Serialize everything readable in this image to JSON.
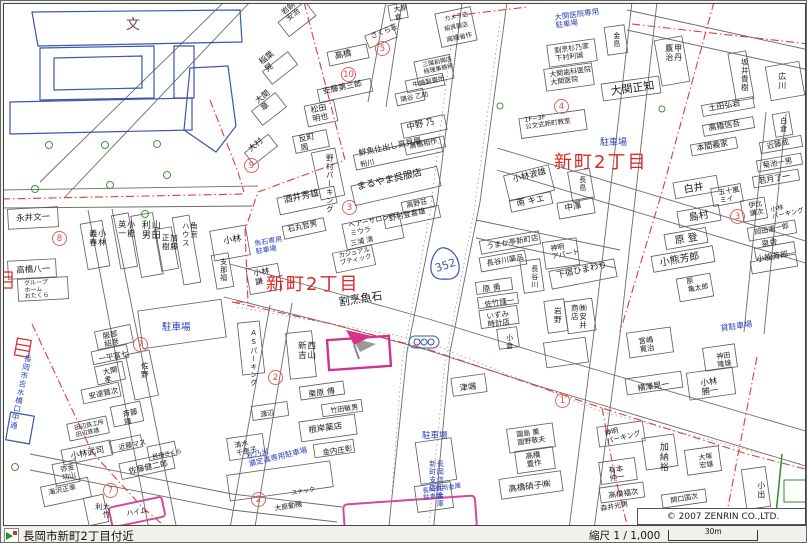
{
  "map": {
    "copyright": "© 2007 ZENRIN CO.,LTD.",
    "route_shield": {
      "number": "352"
    },
    "colors": {
      "boundary_red": "#e23b3b",
      "label_blue": "#2a3fb8",
      "district_red": "#e02525",
      "highlight_magenta": "#cf3390",
      "road_gray": "#666666",
      "school_blue": "#3a56b0",
      "tree_green": "#4a8f3f"
    },
    "district_labels": [
      {
        "t": "新町2丁目",
        "x": 262,
        "y": 271,
        "s": 18,
        "c": "r"
      },
      {
        "t": "新町2丁目",
        "x": 550,
        "y": 149,
        "s": 18,
        "c": "r"
      }
    ],
    "labels": [
      {
        "t": "文",
        "x": 122,
        "y": 14,
        "s": 14,
        "c": "p"
      },
      {
        "t": "稲葉\n晃",
        "x": 254,
        "y": 56,
        "s": 8,
        "r": -38
      },
      {
        "t": "大関\n章",
        "x": 250,
        "y": 95,
        "s": 8,
        "r": -38
      },
      {
        "t": "大村",
        "x": 243,
        "y": 143,
        "s": 8,
        "r": -38
      },
      {
        "t": "岩銅\n安治",
        "x": 276,
        "y": 6,
        "s": 7.5,
        "r": -38
      },
      {
        "t": "高橋",
        "x": 330,
        "y": 49,
        "s": 8.5,
        "r": -12
      },
      {
        "t": "安藤第三郎",
        "x": 318,
        "y": 84,
        "s": 8,
        "r": -12
      },
      {
        "t": "松田\n明也",
        "x": 306,
        "y": 103,
        "s": 8,
        "r": -12
      },
      {
        "t": "反町\n周",
        "x": 294,
        "y": 132,
        "s": 8,
        "r": -12
      },
      {
        "t": "さくら荘",
        "x": 366,
        "y": 30,
        "s": 7,
        "r": -22
      },
      {
        "t": "大原\n倉",
        "x": 389,
        "y": 3,
        "s": 7,
        "r": -10
      },
      {
        "t": "中野 乃",
        "x": 402,
        "y": 120,
        "s": 8.5,
        "r": -12
      },
      {
        "t": "高橋相作",
        "x": 405,
        "y": 140,
        "s": 7,
        "r": -12
      },
      {
        "t": "鮮魚仕出し高見屋",
        "x": 354,
        "y": 146,
        "s": 8,
        "r": -12
      },
      {
        "t": "粉川",
        "x": 356,
        "y": 158,
        "s": 7,
        "r": -12
      },
      {
        "t": "まるやま呉服店",
        "x": 352,
        "y": 179,
        "s": 9.5,
        "r": -13
      },
      {
        "t": "高野荘",
        "x": 402,
        "y": 199,
        "s": 7,
        "r": -12
      },
      {
        "t": "野村登喜雄",
        "x": 384,
        "y": 211,
        "s": 7.5,
        "r": -12
      },
      {
        "t": "ヘアーサロン\nミウラ",
        "x": 344,
        "y": 219,
        "s": 7,
        "r": -12
      },
      {
        "t": "三浦 清",
        "x": 346,
        "y": 237,
        "s": 7,
        "r": -12
      },
      {
        "t": "カジュアル\nブティック",
        "x": 334,
        "y": 249,
        "s": 6.5,
        "r": -12
      },
      {
        "t": "酒井秀雄",
        "x": 279,
        "y": 193,
        "s": 9,
        "r": -12
      },
      {
        "t": "石丸哲男",
        "x": 283,
        "y": 222,
        "s": 7.5,
        "r": -12
      },
      {
        "t": "小林\n謙",
        "x": 249,
        "y": 266,
        "s": 8,
        "r": -10
      },
      {
        "t": "割烹魚石",
        "x": 334,
        "y": 293,
        "s": 11,
        "r": -9
      },
      {
        "t": "野村パーキング",
        "x": 321,
        "y": 150,
        "s": 7.5,
        "v": true
      },
      {
        "t": "小林",
        "x": 219,
        "y": 234,
        "s": 9,
        "r": -10
      },
      {
        "t": "支那福",
        "x": 215,
        "y": 254,
        "s": 7,
        "v": true
      },
      {
        "t": "小林\n義春",
        "x": 84,
        "y": 225,
        "s": 8,
        "v": true
      },
      {
        "t": "小能\n英一",
        "x": 113,
        "y": 216,
        "s": 8,
        "v": true
      },
      {
        "t": "山田\n利男",
        "x": 135,
        "y": 216,
        "s": 9,
        "v": true
      },
      {
        "t": "加藤\n正樹",
        "x": 157,
        "y": 230,
        "s": 7.5,
        "v": true
      },
      {
        "t": "魚京\nハウス",
        "x": 177,
        "y": 218,
        "s": 7.5,
        "v": true
      },
      {
        "t": "永井文一",
        "x": 12,
        "y": 211,
        "s": 8.5,
        "r": -3
      },
      {
        "t": "高橋八一",
        "x": 12,
        "y": 263,
        "s": 8.5,
        "r": -3
      },
      {
        "t": "グループ\nホーム\nおたくら",
        "x": 20,
        "y": 277,
        "s": 6,
        "r": -3
      },
      {
        "t": "甲丹\n鷹治",
        "x": 660,
        "y": 40,
        "s": 8,
        "v": true
      },
      {
        "t": "坂井貴樹",
        "x": 736,
        "y": 54,
        "s": 7.5,
        "v": true
      },
      {
        "t": "広川",
        "x": 773,
        "y": 68,
        "s": 8,
        "v": true
      },
      {
        "t": "土田弘岩",
        "x": 704,
        "y": 101,
        "s": 8,
        "r": -10
      },
      {
        "t": "高橋信吾",
        "x": 704,
        "y": 121,
        "s": 8,
        "r": -10
      },
      {
        "t": "本間義家",
        "x": 692,
        "y": 141,
        "s": 8,
        "r": -10
      },
      {
        "t": "白倉",
        "x": 775,
        "y": 113,
        "s": 7,
        "v": true
      },
      {
        "t": "近藤成",
        "x": 762,
        "y": 139,
        "s": 7.5,
        "r": -12
      },
      {
        "t": "菊池一男",
        "x": 758,
        "y": 158,
        "s": 7.5,
        "r": -10
      },
      {
        "t": "若月了一",
        "x": 754,
        "y": 174,
        "s": 8,
        "r": -10
      },
      {
        "t": "五十嵐\nミイ",
        "x": 714,
        "y": 186,
        "s": 7,
        "r": -10
      },
      {
        "t": "白井",
        "x": 679,
        "y": 181,
        "s": 10,
        "r": -10
      },
      {
        "t": "島村",
        "x": 684,
        "y": 209,
        "s": 10,
        "r": -10
      },
      {
        "t": "原 登",
        "x": 670,
        "y": 232,
        "s": 10,
        "r": -10
      },
      {
        "t": "小熊芳郎",
        "x": 655,
        "y": 254,
        "s": 10,
        "r": -10
      },
      {
        "t": "原\n亀太郎",
        "x": 682,
        "y": 275,
        "s": 7,
        "r": -10
      },
      {
        "t": "伊比\n謙次",
        "x": 744,
        "y": 199,
        "s": 7,
        "r": -10
      },
      {
        "t": "小林\nパーキング",
        "x": 766,
        "y": 203,
        "s": 6.5,
        "r": -12
      },
      {
        "t": "岡田憲一郎",
        "x": 750,
        "y": 226,
        "s": 7,
        "r": -12
      },
      {
        "t": "泉舎",
        "x": 757,
        "y": 237,
        "s": 8,
        "r": -10
      },
      {
        "t": "小能芳郎",
        "x": 752,
        "y": 252,
        "s": 8,
        "r": -10
      },
      {
        "t": "大関正知",
        "x": 606,
        "y": 82,
        "s": 11,
        "r": -8
      },
      {
        "t": "割烹杉乃家\n下村利誠",
        "x": 550,
        "y": 44,
        "s": 7,
        "r": -8
      },
      {
        "t": "大関歯科医院\n大関医院",
        "x": 545,
        "y": 68,
        "s": 7,
        "r": -8
      },
      {
        "t": "金島",
        "x": 608,
        "y": 28,
        "s": 7,
        "v": true
      },
      {
        "t": "1F~3F\n公文式新町教室",
        "x": 520,
        "y": 113,
        "s": 6.5,
        "r": -8
      },
      {
        "t": "カメラ店",
        "x": 440,
        "y": 13,
        "s": 6,
        "r": -12
      },
      {
        "t": "紹呉服店",
        "x": 440,
        "y": 23,
        "s": 6,
        "r": -12
      },
      {
        "t": "高橋省作",
        "x": 442,
        "y": 33,
        "s": 6.5,
        "r": -12
      },
      {
        "t": "三陽創興店\n経理事務所",
        "x": 418,
        "y": 59,
        "s": 6,
        "r": -12
      },
      {
        "t": "中嶋製畳所",
        "x": 408,
        "y": 78,
        "s": 6.5,
        "r": -12
      },
      {
        "t": "隅谷 乙助",
        "x": 396,
        "y": 93,
        "s": 6.5,
        "r": -12
      },
      {
        "t": "小林波雄",
        "x": 508,
        "y": 172,
        "s": 8.5,
        "r": -14
      },
      {
        "t": "南 キエ",
        "x": 512,
        "y": 196,
        "s": 8.5,
        "r": -10
      },
      {
        "t": "中澤",
        "x": 560,
        "y": 201,
        "s": 8.5,
        "r": -10
      },
      {
        "t": "長島",
        "x": 574,
        "y": 172,
        "s": 7,
        "v": true
      },
      {
        "t": "うまか亭新町店",
        "x": 482,
        "y": 239,
        "s": 7.5,
        "r": -10
      },
      {
        "t": "長谷川薬品",
        "x": 482,
        "y": 256,
        "s": 7.5,
        "r": -10
      },
      {
        "t": "神明\nアパート",
        "x": 546,
        "y": 242,
        "s": 7,
        "r": -10
      },
      {
        "t": "下宿ひまわり",
        "x": 552,
        "y": 268,
        "s": 8.5,
        "r": -12
      },
      {
        "t": "長谷川",
        "x": 526,
        "y": 261,
        "s": 7,
        "v": true
      },
      {
        "t": "原 勇",
        "x": 478,
        "y": 282,
        "s": 8,
        "r": -8
      },
      {
        "t": "佐竹謹一",
        "x": 480,
        "y": 297,
        "s": 7.5,
        "r": -8
      },
      {
        "t": "いずみ\n時計店",
        "x": 482,
        "y": 309,
        "s": 7.5,
        "r": -8
      },
      {
        "t": "岩野",
        "x": 549,
        "y": 303,
        "s": 7.5,
        "v": true
      },
      {
        "t": "㈱安井\n商店",
        "x": 566,
        "y": 300,
        "s": 7.5,
        "v": true
      },
      {
        "t": "津端",
        "x": 455,
        "y": 381,
        "s": 8.5,
        "r": -8
      },
      {
        "t": "小倉",
        "x": 501,
        "y": 330,
        "s": 7,
        "v": true
      },
      {
        "t": "國島 薫\n國野敬夫",
        "x": 512,
        "y": 428,
        "s": 7,
        "r": -8
      },
      {
        "t": "高橋\n豊作",
        "x": 521,
        "y": 449,
        "s": 7.5,
        "r": -8
      },
      {
        "t": "高橋硝子㈱",
        "x": 504,
        "y": 482,
        "s": 8.5,
        "r": -8
      },
      {
        "t": "宮嶋\n寛治",
        "x": 634,
        "y": 334,
        "s": 7.5,
        "r": -8
      },
      {
        "t": "神田\n隆雄",
        "x": 712,
        "y": 350,
        "s": 7,
        "r": -8
      },
      {
        "t": "小林\n勝一",
        "x": 696,
        "y": 376,
        "s": 8.5,
        "r": -8
      },
      {
        "t": "横澤晃一",
        "x": 633,
        "y": 381,
        "s": 8,
        "r": -8
      },
      {
        "t": "神明\nパーキング",
        "x": 600,
        "y": 427,
        "s": 7,
        "r": -14
      },
      {
        "t": "加納裕",
        "x": 653,
        "y": 438,
        "s": 9,
        "v": true
      },
      {
        "t": "有本\n仲一",
        "x": 604,
        "y": 463,
        "s": 7.5,
        "r": -8
      },
      {
        "t": "大塚\n宏雄",
        "x": 694,
        "y": 451,
        "s": 7,
        "r": -8
      },
      {
        "t": "高橋福次",
        "x": 604,
        "y": 488,
        "s": 7.5,
        "r": -8
      },
      {
        "t": "関口国次",
        "x": 666,
        "y": 494,
        "s": 7,
        "r": -10
      },
      {
        "t": "小出",
        "x": 752,
        "y": 477,
        "s": 8,
        "v": true
      },
      {
        "t": "森井光男",
        "x": 596,
        "y": 502,
        "s": 7,
        "r": -10
      },
      {
        "t": "服部\n紹彦",
        "x": 98,
        "y": 329,
        "s": 7.5,
        "r": -12
      },
      {
        "t": "一平富七",
        "x": 94,
        "y": 352,
        "s": 7.5,
        "r": -12
      },
      {
        "t": "大関\n孝",
        "x": 98,
        "y": 365,
        "s": 7.5,
        "r": -12
      },
      {
        "t": "佐野",
        "x": 136,
        "y": 358,
        "s": 7.5,
        "v": true
      },
      {
        "t": "安達賢次",
        "x": 84,
        "y": 389,
        "s": 7.5,
        "r": -12
      },
      {
        "t": "斉藤\n隆",
        "x": 118,
        "y": 407,
        "s": 7.5,
        "r": -12
      },
      {
        "t": "田辺鉄工所\n田辺鉄雄",
        "x": 70,
        "y": 422,
        "s": 6,
        "r": -12
      },
      {
        "t": "近藤マス",
        "x": 114,
        "y": 441,
        "s": 7,
        "r": -12
      },
      {
        "t": "小林武司",
        "x": 66,
        "y": 449,
        "s": 8.5,
        "r": -12
      },
      {
        "t": "佐藤健二郎",
        "x": 124,
        "y": 464,
        "s": 8,
        "r": -12
      },
      {
        "t": "民宿さくら",
        "x": 148,
        "y": 451,
        "s": 6,
        "r": -12
      },
      {
        "t": "弥金\n功山",
        "x": 56,
        "y": 463,
        "s": 7,
        "r": -12
      },
      {
        "t": "滝沢正幸",
        "x": 44,
        "y": 486,
        "s": 7,
        "r": -12
      },
      {
        "t": "大竹利",
        "x": 90,
        "y": 499,
        "s": 7,
        "v": true
      },
      {
        "t": "ハイム",
        "x": 122,
        "y": 507,
        "s": 7,
        "r": -10
      },
      {
        "t": "スナック",
        "x": 287,
        "y": 487,
        "s": 6,
        "r": -10
      },
      {
        "t": "大原動機",
        "x": 270,
        "y": 502,
        "s": 7,
        "r": -10
      },
      {
        "t": "西山\n新吉",
        "x": 292,
        "y": 337,
        "s": 8.5,
        "v": true
      },
      {
        "t": "ASパーキング",
        "x": 245,
        "y": 325,
        "s": 7,
        "v": true
      },
      {
        "t": "栗原 傳",
        "x": 304,
        "y": 387,
        "s": 8,
        "r": -8
      },
      {
        "t": "竹田敏男",
        "x": 326,
        "y": 404,
        "s": 7,
        "r": -8
      },
      {
        "t": "根岸薬店",
        "x": 304,
        "y": 423,
        "s": 8.5,
        "r": -8
      },
      {
        "t": "金内庄彰",
        "x": 318,
        "y": 445,
        "s": 7.5,
        "r": -8
      },
      {
        "t": "清水\n千恵子",
        "x": 230,
        "y": 439,
        "s": 7,
        "r": -12
      },
      {
        "t": "渡辺",
        "x": 256,
        "y": 408,
        "s": 7,
        "r": -10
      },
      {
        "t": "駐車場",
        "x": 158,
        "y": 319,
        "s": 9.5,
        "c": "b"
      },
      {
        "t": "駐車場",
        "x": 596,
        "y": 135,
        "s": 9,
        "c": "b"
      },
      {
        "t": "駐車場",
        "x": 418,
        "y": 428,
        "s": 8.5,
        "c": "b"
      },
      {
        "t": "貸駐車場",
        "x": 716,
        "y": 321,
        "s": 8,
        "c": "b",
        "r": -8
      },
      {
        "t": "魚石専用\n駐車場",
        "x": 250,
        "y": 237,
        "s": 7,
        "c": "b",
        "r": -10
      },
      {
        "t": "大関医院専用\n駐車場",
        "x": 550,
        "y": 10,
        "s": 7.5,
        "c": "b",
        "r": -8
      },
      {
        "t": "松乃米\n瀬定眞専用駐車場",
        "x": 242,
        "y": 449,
        "s": 7.5,
        "c": "b",
        "r": -14
      },
      {
        "t": "長岡信用金庫\n新町支店",
        "x": 424,
        "y": 456,
        "s": 7,
        "c": "b",
        "v": true
      },
      {
        "t": "長岡信用金庫\n駐車場",
        "x": 418,
        "y": 484,
        "s": 6.5,
        "c": "b",
        "r": -8
      },
      {
        "t": "長岡市吉水橋口中通",
        "x": 20,
        "y": 350,
        "s": 7.5,
        "c": "b",
        "v": true,
        "r": 12
      }
    ],
    "block_numbers": [
      {
        "n": "9",
        "x": 240,
        "y": 154
      },
      {
        "n": "5",
        "x": 371,
        "y": 37
      },
      {
        "n": "10",
        "x": 337,
        "y": 63
      },
      {
        "n": "3",
        "x": 338,
        "y": 196
      },
      {
        "n": "8",
        "x": 48,
        "y": 227
      },
      {
        "n": "4",
        "x": 550,
        "y": 95
      },
      {
        "n": "3",
        "x": 726,
        "y": 205
      },
      {
        "n": "1",
        "x": 551,
        "y": 389
      },
      {
        "n": "2",
        "x": 264,
        "y": 366
      },
      {
        "n": "7",
        "x": 129,
        "y": 333
      },
      {
        "n": "7",
        "x": 99,
        "y": 479
      },
      {
        "n": "2",
        "x": 247,
        "y": 488
      }
    ]
  },
  "status_bar": {
    "location": "長岡市新町2丁目付近",
    "scale_label": "縮尺 1 / 1,000",
    "scale_distance": "30m"
  }
}
